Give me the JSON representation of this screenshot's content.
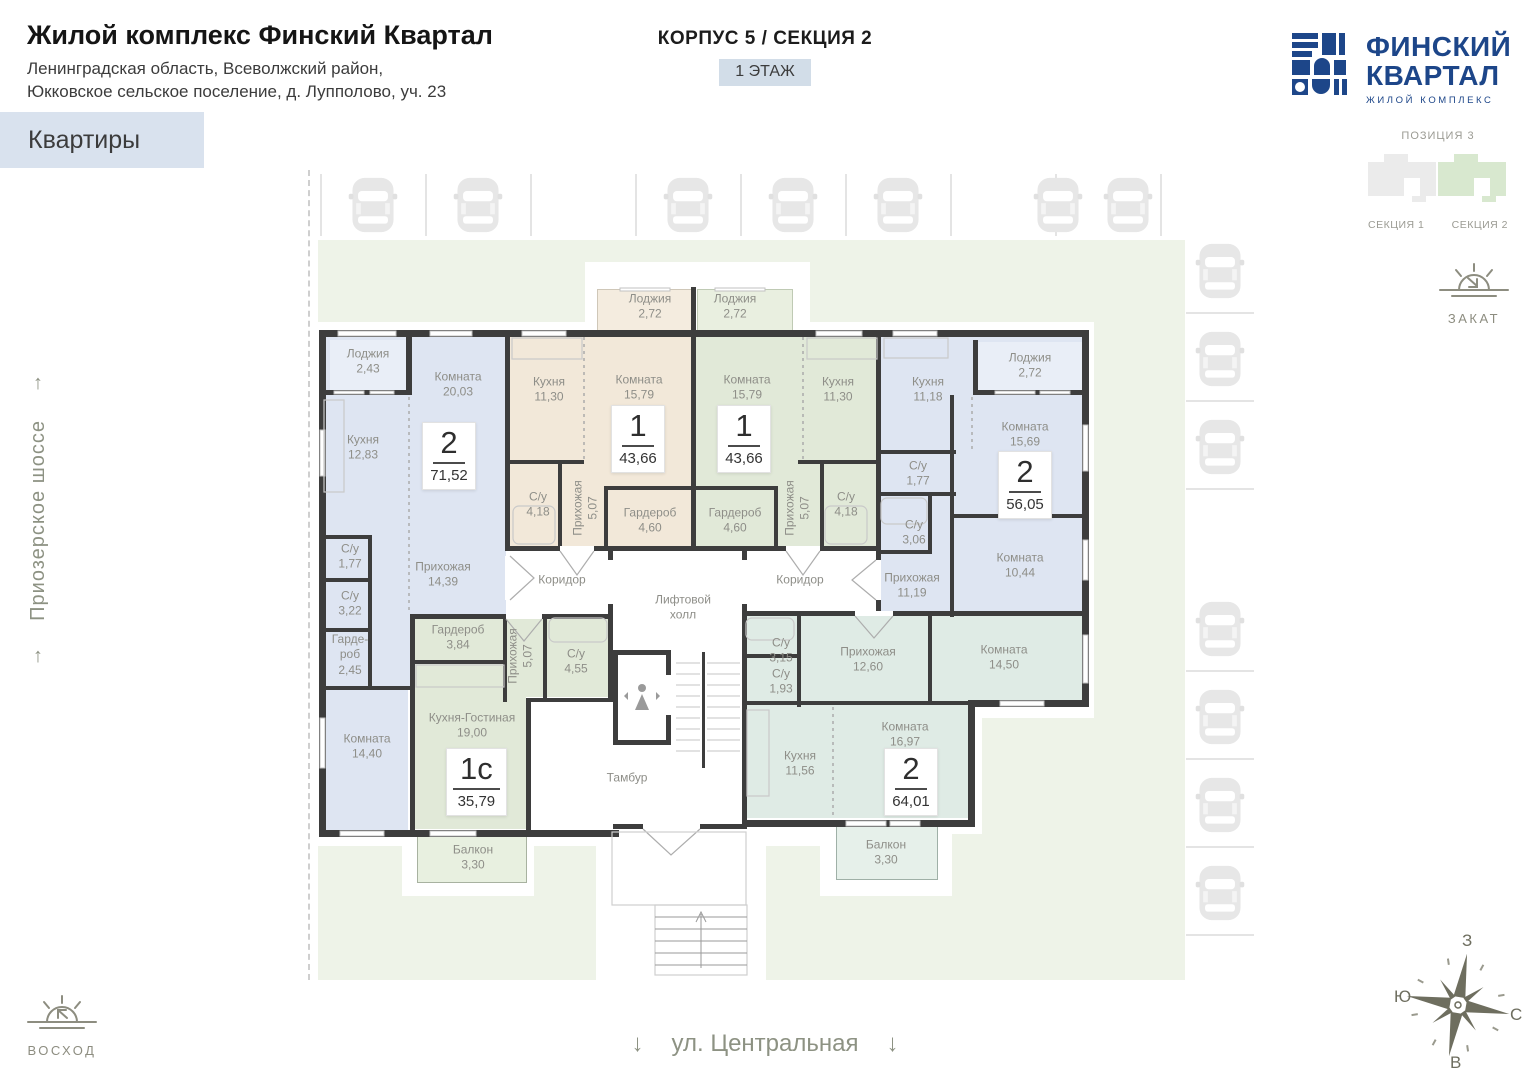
{
  "header": {
    "title": "Жилой комплекс Финский Квартал",
    "subtitle1": "Ленинградская область, Всеволжский район,",
    "subtitle2": "Юкковское сельское поселение, д. Лупполово, уч. 23",
    "corpus": "КОРПУС 5 / СЕКЦИЯ 2",
    "floor": "1 ЭТАЖ",
    "filter": "Квартиры"
  },
  "logo": {
    "line1": "ФИНСКИЙ",
    "line2": "КВАРТАЛ",
    "tagline": "ЖИЛОЙ КОМПЛЕКС"
  },
  "position": {
    "label": "ПОЗИЦИЯ 3",
    "section1": "СЕКЦИЯ 1",
    "section2": "СЕКЦИЯ 2"
  },
  "site": {
    "road_left": "Приозерское шоссе",
    "street_bottom": "ул. Центральная",
    "sunrise": "ВОСХОД",
    "sunset": "ЗАКАТ",
    "compass": {
      "top": "З",
      "left": "Ю",
      "right": "С",
      "bottom": "В"
    }
  },
  "icons": {
    "arrow_up": "↑",
    "arrow_down": "↓"
  },
  "colors": {
    "accent_blue_room": "#dee5f2",
    "beige_room": "#f2e8d9",
    "green_room": "#e1e9d8",
    "teal_room": "#dfebe5",
    "yard": "#eef3e8",
    "walls": "#3d3d3d",
    "brand_navy": "#1d4689",
    "floor_badge_bg": "#d2dde8",
    "filter_bg": "#d9e2ee"
  },
  "plan": {
    "common": {
      "corridor_left": "Коридор",
      "corridor_right": "Коридор",
      "lift_hall": "Лифтовой холл",
      "tambour": "Тамбур"
    },
    "apartments": [
      {
        "id": "2-room-71",
        "type": "2",
        "total_area": "71,52",
        "rooms": [
          {
            "name": "Лоджия",
            "area": "2,43"
          },
          {
            "name": "Кухня",
            "area": "12,83"
          },
          {
            "name": "Комната",
            "area": "20,03"
          },
          {
            "name": "С/у",
            "area": "1,77"
          },
          {
            "name": "С/у",
            "area": "3,22"
          },
          {
            "name": "Гарде-роб",
            "area": "2,45"
          },
          {
            "name": "Прихожая",
            "area": "14,39"
          },
          {
            "name": "Комната",
            "area": "14,40"
          }
        ]
      },
      {
        "id": "1-room-43-left",
        "type": "1",
        "total_area": "43,66",
        "rooms": [
          {
            "name": "Лоджия",
            "area": "2,72"
          },
          {
            "name": "Кухня",
            "area": "11,30"
          },
          {
            "name": "Комната",
            "area": "15,79"
          },
          {
            "name": "С/у",
            "area": "4,18"
          },
          {
            "name": "Прихожая",
            "area": "5,07"
          },
          {
            "name": "Гардероб",
            "area": "4,60"
          }
        ]
      },
      {
        "id": "1-room-43-right",
        "type": "1",
        "total_area": "43,66",
        "rooms": [
          {
            "name": "Лоджия",
            "area": "2,72"
          },
          {
            "name": "Комната",
            "area": "15,79"
          },
          {
            "name": "Кухня",
            "area": "11,30"
          },
          {
            "name": "Гардероб",
            "area": "4,60"
          },
          {
            "name": "Прихожая",
            "area": "5,07"
          },
          {
            "name": "С/у",
            "area": "4,18"
          }
        ]
      },
      {
        "id": "2-room-56",
        "type": "2",
        "total_area": "56,05",
        "rooms": [
          {
            "name": "Кухня",
            "area": "11,18"
          },
          {
            "name": "Лоджия",
            "area": "2,72"
          },
          {
            "name": "Комната",
            "area": "15,69"
          },
          {
            "name": "С/у",
            "area": "1,77"
          },
          {
            "name": "С/у",
            "area": "3,06"
          },
          {
            "name": "Прихожая",
            "area": "11,19"
          },
          {
            "name": "Комната",
            "area": "10,44"
          }
        ]
      },
      {
        "id": "1c-room-35",
        "type": "1с",
        "total_area": "35,79",
        "rooms": [
          {
            "name": "Гардероб",
            "area": "3,84"
          },
          {
            "name": "Прихожая",
            "area": "5,07"
          },
          {
            "name": "С/у",
            "area": "4,55"
          },
          {
            "name": "Кухня-Гостиная",
            "area": "19,00"
          },
          {
            "name": "Балкон",
            "area": "3,30"
          }
        ]
      },
      {
        "id": "2-room-64",
        "type": "2",
        "total_area": "64,01",
        "rooms": [
          {
            "name": "С/у",
            "area": "3,15"
          },
          {
            "name": "С/у",
            "area": "1,93"
          },
          {
            "name": "Прихожая",
            "area": "12,60"
          },
          {
            "name": "Комната",
            "area": "14,50"
          },
          {
            "name": "Комната",
            "area": "16,97"
          },
          {
            "name": "Кухня",
            "area": "11,56"
          },
          {
            "name": "Балкон",
            "area": "3,30"
          }
        ]
      }
    ]
  }
}
